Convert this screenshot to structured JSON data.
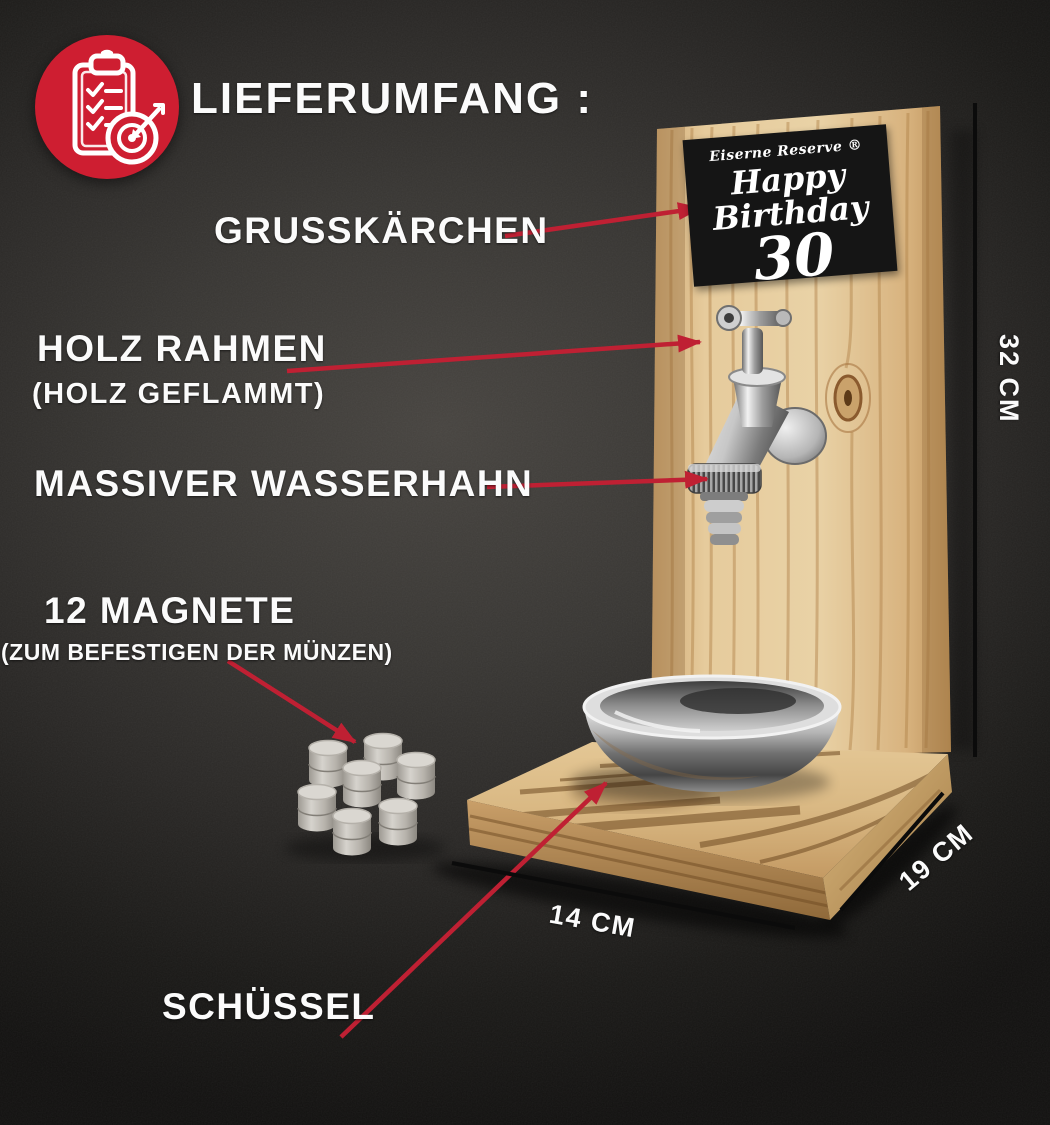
{
  "header": {
    "title": "LIEFERUMFANG :",
    "icon": "clipboard-checklist-target-icon",
    "icon_bg": "#ce1e31"
  },
  "annotations": {
    "card": {
      "label": "GRUSSKÄRCHEN"
    },
    "frame": {
      "label": "HOLZ RAHMEN",
      "sub": "(HOLZ GEFLAMMT)"
    },
    "tap": {
      "label": "MASSIVER WASSERHAHN"
    },
    "magnets": {
      "label": "12 MAGNETE",
      "sub": "(ZUM BEFESTIGEN DER MÜNZEN)"
    },
    "bowl": {
      "label": "SCHÜSSEL"
    }
  },
  "greeting_card": {
    "brand": "Eiserne Reserve ®",
    "message": "Happy Birthday",
    "number": "30"
  },
  "dimensions": {
    "height_label": "32 CM",
    "depth_label": "19 CM",
    "width_label": "14 CM"
  },
  "colors": {
    "arrow_red": "#bf2033",
    "icon_red": "#ce1e31",
    "dimension_line": "#0b0b0b",
    "text": "#fbfbfb",
    "card_bg": "#151515",
    "wood_light": "#e6cb9c",
    "wood_mid": "#d0a872",
    "wood_burn": "#6e4a22",
    "background": "#2e2c2a"
  }
}
